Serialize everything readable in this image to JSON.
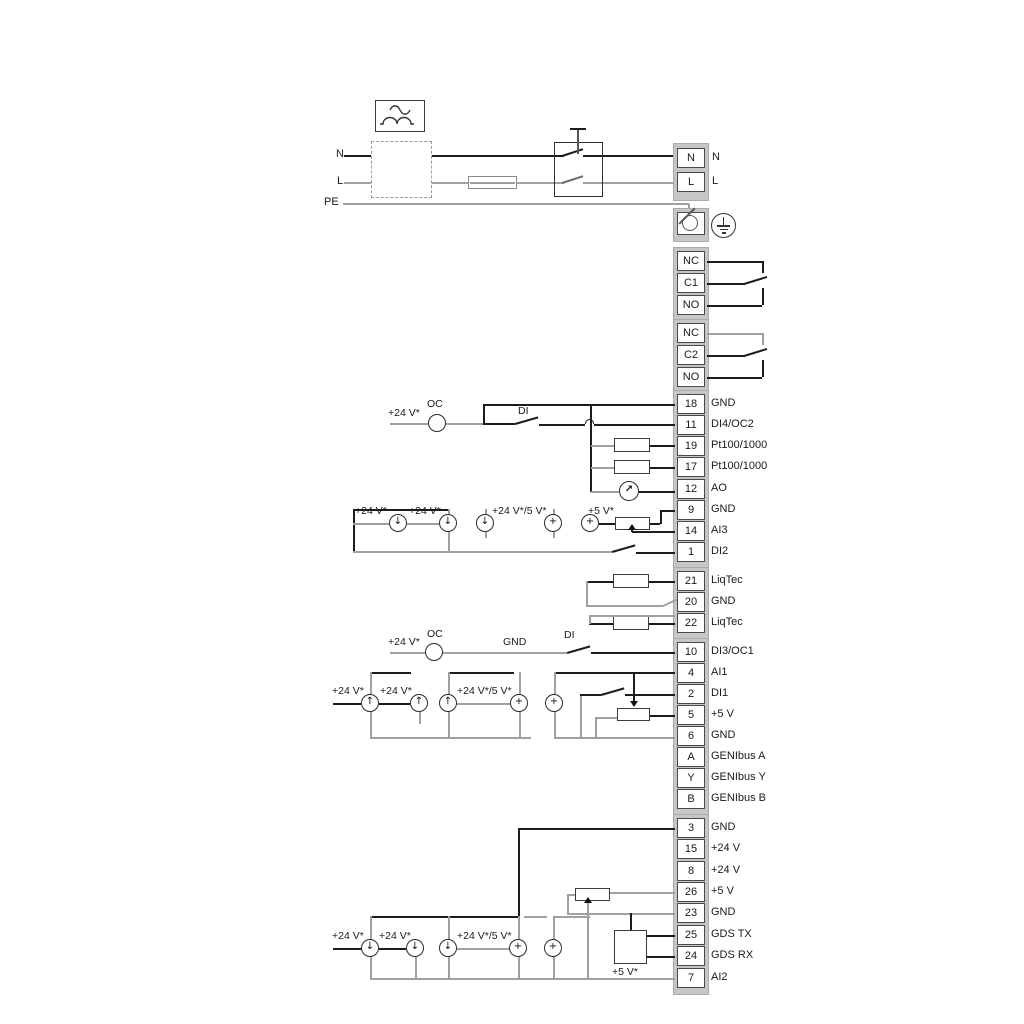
{
  "power": {
    "n_left": "N",
    "l_left": "L",
    "pe": "PE",
    "n_right": "N",
    "l_right": "L"
  },
  "relay1": [
    "NC",
    "C1",
    "NO"
  ],
  "relay2": [
    "NC",
    "C2",
    "NO"
  ],
  "io1": [
    [
      "18",
      "GND"
    ],
    [
      "11",
      "DI4/OC2"
    ],
    [
      "19",
      "Pt100/1000"
    ],
    [
      "17",
      "Pt100/1000"
    ],
    [
      "12",
      "AO"
    ],
    [
      "9",
      "GND"
    ],
    [
      "14",
      "AI3"
    ],
    [
      "1",
      "DI2"
    ]
  ],
  "liqtec": [
    [
      "21",
      "LiqTec"
    ],
    [
      "20",
      "GND"
    ],
    [
      "22",
      "LiqTec"
    ]
  ],
  "io2": [
    [
      "10",
      "DI3/OC1"
    ],
    [
      "4",
      "AI1"
    ],
    [
      "2",
      "DI1"
    ],
    [
      "5",
      "+5 V"
    ],
    [
      "6",
      "GND"
    ],
    [
      "A",
      "GENIbus A"
    ],
    [
      "Y",
      "GENIbus Y"
    ],
    [
      "B",
      "GENIbus B"
    ]
  ],
  "io3": [
    [
      "3",
      "GND"
    ],
    [
      "15",
      "+24 V"
    ],
    [
      "8",
      "+24 V"
    ],
    [
      "26",
      "+5 V"
    ],
    [
      "23",
      "GND"
    ],
    [
      "25",
      "GDS TX"
    ],
    [
      "24",
      "GDS RX"
    ],
    [
      "7",
      "AI2"
    ]
  ],
  "ann": {
    "p24": "+24 V*",
    "p245": "+24 V*/5 V*",
    "p5": "+5 V*",
    "oc": "OC",
    "di": "DI",
    "gnd": "GND"
  },
  "glyphs": {
    "down": "↓",
    "up": "↑",
    "plus": "+",
    "meter": "↗"
  },
  "colors": {
    "wire": "#1c1c1c",
    "rail": "#a0a0a0",
    "cell_border": "#4a4a4a",
    "strip_bg": "#c6c6c6",
    "text": "#1a1a1a"
  }
}
